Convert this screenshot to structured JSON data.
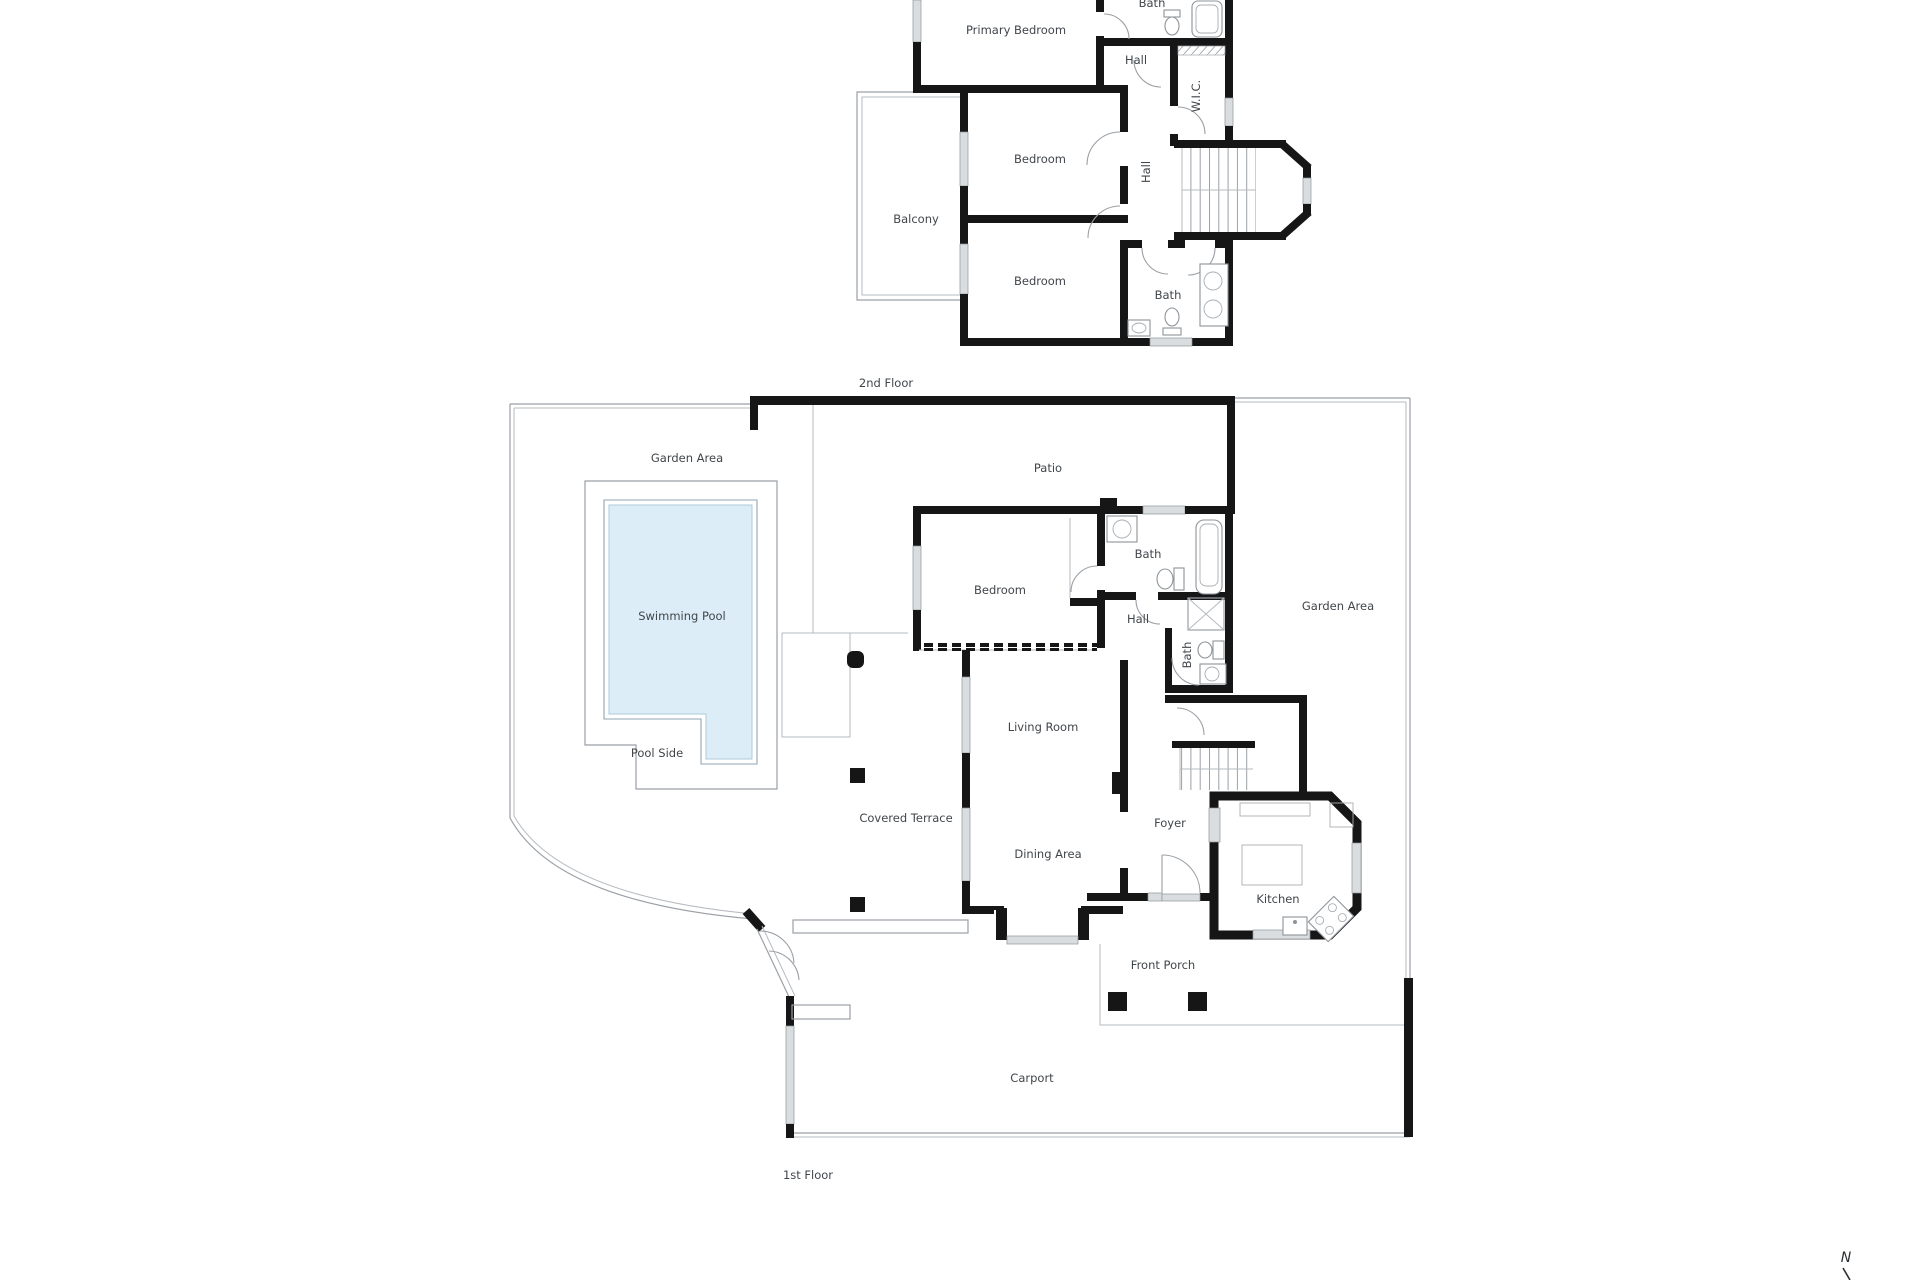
{
  "colors": {
    "wall": "#161616",
    "line": "#9aa0a6",
    "window": "#dadddf",
    "pool": "#dcedf8",
    "label": "#41464b"
  },
  "floor2": {
    "floor_label": "2nd Floor",
    "rooms": {
      "primary_bedroom": "Primary Bedroom",
      "bath_top": "Bath",
      "hall_upper": "Hall",
      "wic": "W.I.C.",
      "hall_main": "Hall",
      "bedroom_mid": "Bedroom",
      "bedroom_lower": "Bedroom",
      "balcony": "Balcony",
      "bath_lower": "Bath"
    }
  },
  "floor1": {
    "floor_label": "1st Floor",
    "rooms": {
      "garden_area_left": "Garden Area",
      "patio": "Patio",
      "swimming_pool": "Swimming Pool",
      "pool_side": "Pool Side",
      "bedroom": "Bedroom",
      "bath_main": "Bath",
      "hall": "Hall",
      "bath_small": "Bath",
      "garden_area_right": "Garden Area",
      "living_room": "Living Room",
      "covered_terrace": "Covered Terrace",
      "dining_area": "Dining Area",
      "foyer": "Foyer",
      "kitchen": "Kitchen",
      "front_porch": "Front Porch",
      "carport": "Carport"
    }
  },
  "compass": {
    "north": "N"
  }
}
